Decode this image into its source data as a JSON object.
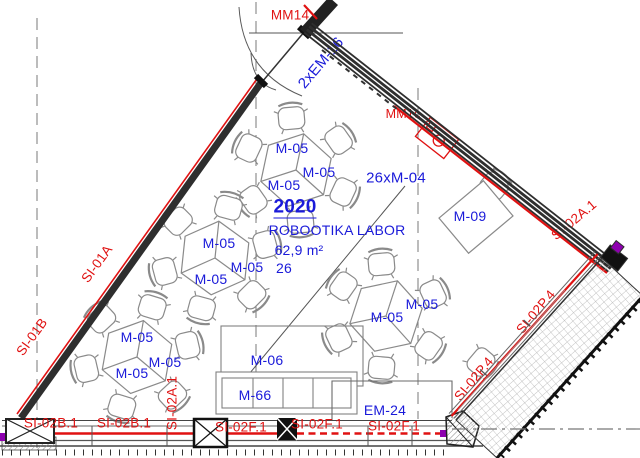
{
  "drawing": {
    "type": "architectural floor plan",
    "room": {
      "number": "2020",
      "name": "ROBOOTIKA LABOR",
      "area": "62,9 m²",
      "capacity": "26"
    },
    "colors": {
      "label_blue": "#1a1ad9",
      "label_red": "#e01212",
      "wall_dark": "#2e2e2e",
      "grid_gray": "#787878",
      "furniture_gray": "#8a8a8a",
      "accent_purple": "#8e00b0"
    },
    "labels": [
      {
        "id": "room-number",
        "text": "2020",
        "x": 295,
        "y": 208,
        "color": "blue",
        "size": 19,
        "bold": true,
        "underline": true
      },
      {
        "id": "room-name",
        "text": "ROBOOTIKA LABOR",
        "x": 337,
        "y": 230,
        "color": "blue",
        "size": 14
      },
      {
        "id": "room-area",
        "text": "62,9 m²",
        "x": 299,
        "y": 250,
        "color": "blue",
        "size": 14
      },
      {
        "id": "room-capacity",
        "text": "26",
        "x": 284,
        "y": 268,
        "color": "blue",
        "size": 14
      },
      {
        "id": "em16",
        "text": "2xEM-16",
        "x": 321,
        "y": 63,
        "rot": -50,
        "color": "blue",
        "size": 15
      },
      {
        "id": "m04-qty",
        "text": "26xM-04",
        "x": 396,
        "y": 178,
        "color": "blue",
        "size": 15
      },
      {
        "id": "m09",
        "text": "M-09",
        "x": 470,
        "y": 216,
        "color": "blue",
        "size": 14
      },
      {
        "id": "m05-a1",
        "text": "M-05",
        "x": 292,
        "y": 148,
        "color": "blue",
        "size": 14
      },
      {
        "id": "m05-a2",
        "text": "M-05",
        "x": 319,
        "y": 172,
        "color": "blue",
        "size": 14
      },
      {
        "id": "m05-a3",
        "text": "M-05",
        "x": 284,
        "y": 185,
        "color": "blue",
        "size": 14
      },
      {
        "id": "m05-b1",
        "text": "M-05",
        "x": 219,
        "y": 243,
        "color": "blue",
        "size": 14
      },
      {
        "id": "m05-b2",
        "text": "M-05",
        "x": 247,
        "y": 267,
        "color": "blue",
        "size": 14
      },
      {
        "id": "m05-b3",
        "text": "M-05",
        "x": 211,
        "y": 279,
        "color": "blue",
        "size": 14
      },
      {
        "id": "m05-c1",
        "text": "M-05",
        "x": 137,
        "y": 337,
        "color": "blue",
        "size": 14
      },
      {
        "id": "m05-c2",
        "text": "M-05",
        "x": 165,
        "y": 362,
        "color": "blue",
        "size": 14
      },
      {
        "id": "m05-c3",
        "text": "M-05",
        "x": 132,
        "y": 373,
        "color": "blue",
        "size": 14
      },
      {
        "id": "m05-d1",
        "text": "M-05",
        "x": 422,
        "y": 304,
        "color": "blue",
        "size": 14
      },
      {
        "id": "m05-d2",
        "text": "M-05",
        "x": 387,
        "y": 317,
        "color": "blue",
        "size": 14
      },
      {
        "id": "m06",
        "text": "M-06",
        "x": 267,
        "y": 360,
        "color": "blue",
        "size": 14
      },
      {
        "id": "m66",
        "text": "M-66",
        "x": 255,
        "y": 395,
        "color": "blue",
        "size": 14
      },
      {
        "id": "em24",
        "text": "EM-24",
        "x": 385,
        "y": 410,
        "color": "blue",
        "size": 14
      },
      {
        "id": "mm14",
        "text": "MM14",
        "x": 290,
        "y": 15,
        "color": "red",
        "size": 13.5
      },
      {
        "id": "mm1c",
        "text": "MM1c",
        "x": 403,
        "y": 114,
        "color": "red",
        "size": 12.5
      },
      {
        "id": "si01a",
        "text": "SI-01A",
        "x": 97,
        "y": 264,
        "rot": -54,
        "color": "red",
        "size": 13.5
      },
      {
        "id": "si01b",
        "text": "SI-01B",
        "x": 32,
        "y": 337,
        "rot": -54,
        "color": "red",
        "size": 13.5
      },
      {
        "id": "si02b1-1",
        "text": "SI-02B.1",
        "x": 51,
        "y": 423,
        "color": "red",
        "size": 13.5
      },
      {
        "id": "si02b1-2",
        "text": "SI-02B.1",
        "x": 124,
        "y": 423,
        "color": "red",
        "size": 13.5
      },
      {
        "id": "si02a1-bottom",
        "text": "SI-02A.1",
        "x": 172,
        "y": 403,
        "rot": -90,
        "color": "red",
        "size": 13.5
      },
      {
        "id": "si02f1-1",
        "text": "SI-02F.1",
        "x": 241,
        "y": 427,
        "color": "red",
        "size": 13.5
      },
      {
        "id": "si02f1-2",
        "text": "SI-02F.1",
        "x": 317,
        "y": 424,
        "color": "red",
        "size": 13.5
      },
      {
        "id": "si02f1-3",
        "text": "SI-02F.1",
        "x": 394,
        "y": 426,
        "color": "red",
        "size": 13.5
      },
      {
        "id": "si02p4-1",
        "text": "SI-02P.4",
        "x": 474,
        "y": 379,
        "rot": -50,
        "color": "red",
        "size": 13.5
      },
      {
        "id": "si02p4-2",
        "text": "SI-02P.4",
        "x": 536,
        "y": 312,
        "rot": -50,
        "color": "red",
        "size": 13.5
      },
      {
        "id": "si02a1-right",
        "text": "SI-02A.1",
        "x": 574,
        "y": 220,
        "rot": -40,
        "color": "red",
        "size": 13.5
      }
    ],
    "furniture": {
      "tables": [
        {
          "id": "table-a",
          "cx": 296,
          "cy": 170,
          "rot": 12
        },
        {
          "id": "table-b",
          "cx": 215,
          "cy": 258,
          "rot": 6
        },
        {
          "id": "table-c",
          "cx": 137,
          "cy": 357,
          "rot": 10
        },
        {
          "id": "table-d",
          "cx": 386,
          "cy": 316,
          "rot": 18
        }
      ],
      "chair_radius": 52,
      "chair_angles": [
        [
          -95,
          -35,
          25,
          85,
          145,
          205
        ],
        [
          -75,
          -15,
          45,
          105,
          165,
          225
        ],
        [
          -73,
          -13,
          47,
          107,
          167,
          227
        ],
        [
          -95,
          -25,
          35,
          95,
          155,
          215
        ]
      ],
      "extra_chairs": [
        {
          "id": "chair-at-desk",
          "x": 494,
          "y": 186,
          "rot": 40
        },
        {
          "id": "chair-lone",
          "x": 481,
          "y": 362,
          "rot": 130
        }
      ],
      "desk": {
        "id": "desk-m09",
        "cx": 476,
        "cy": 217,
        "w": 58,
        "h": 46,
        "rot": -40
      },
      "fixture": {
        "id": "fixture-mm1c",
        "cx": 437,
        "cy": 138,
        "rot": 38
      }
    }
  }
}
